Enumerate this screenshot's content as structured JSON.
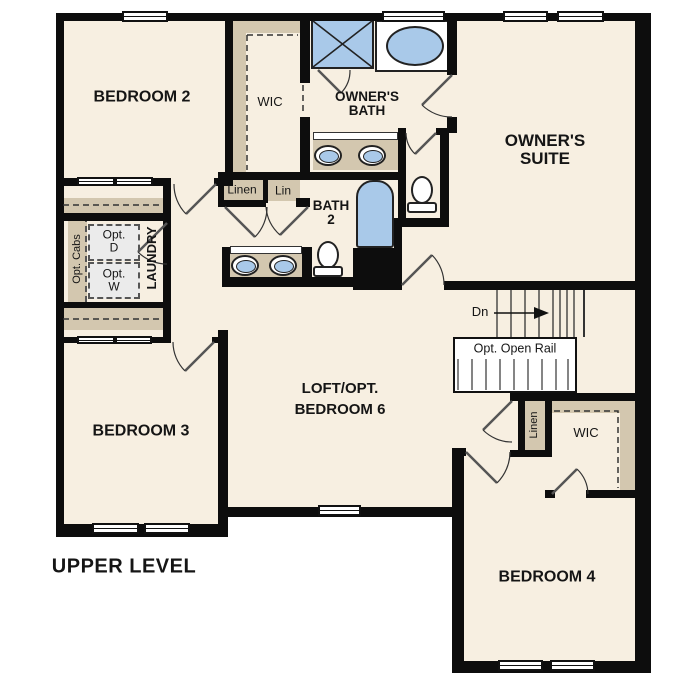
{
  "plan_title": "UPPER LEVEL",
  "rooms": {
    "bedroom2": "BEDROOM 2",
    "bedroom3": "BEDROOM 3",
    "bedroom4": "BEDROOM 4",
    "bedroom6_loft": {
      "line1": "LOFT/OPT.",
      "line2": "BEDROOM 6"
    },
    "owners_suite": {
      "line1": "OWNER'S",
      "line2": "SUITE"
    },
    "owners_bath": {
      "line1": "OWNER'S",
      "line2": "BATH"
    },
    "bath2": {
      "line1": "BATH",
      "line2": "2"
    },
    "wic_owners": "WIC",
    "wic_bedroom4": "WIC",
    "laundry": "LAUNDRY"
  },
  "closets": {
    "linen_hall": "Linen",
    "lin_hall": "Lin",
    "linen_bedroom4": "Linen"
  },
  "laundry_options": {
    "opt_cabs": "Opt. Cabs",
    "opt_dryer": {
      "line1": "Opt.",
      "line2": "D"
    },
    "opt_washer": {
      "line1": "Opt.",
      "line2": "W"
    }
  },
  "stairs": {
    "down": "Dn",
    "open_rail": "Opt. Open Rail"
  },
  "colors": {
    "floor": "#f7efe1",
    "wall": "#0d0d0d",
    "cabinetry_tan": "#d3c7af",
    "fixture_blue": "#a9c9e9",
    "optional_item_fill": "#ebebeb",
    "background": "#ffffff"
  }
}
